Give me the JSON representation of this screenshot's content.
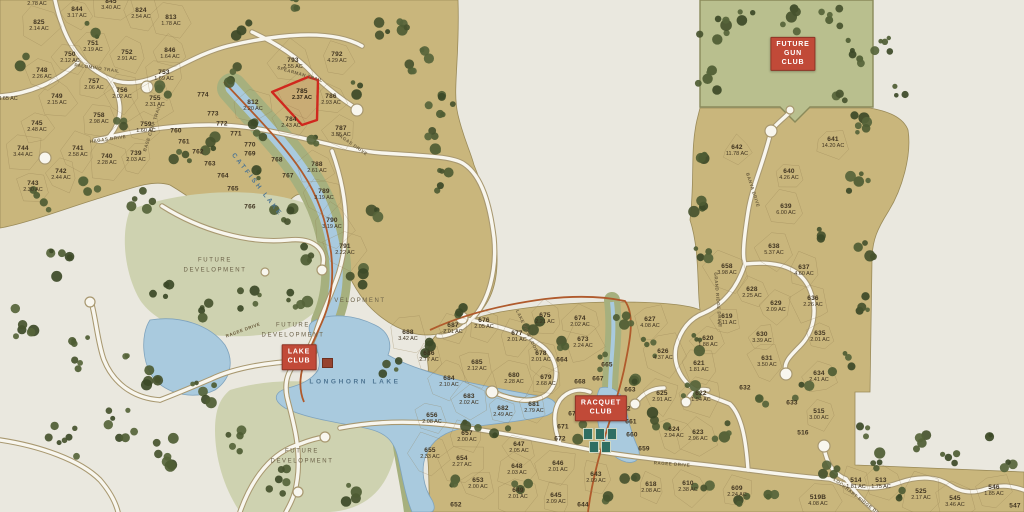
{
  "colors": {
    "parcel": "#c9b67c",
    "grass": "#a6b07e",
    "sage": "#ced2b0",
    "water": "#a9cade",
    "road": "#f8f6ee",
    "trail": "#b05a2c",
    "highlight": "#d0281e",
    "sign_red": "#c14a38",
    "text": "#3f3320"
  },
  "signs": [
    {
      "id": "future-gun-club",
      "text": "FUTURE\nGUN\nCLUB",
      "x": 793,
      "y": 54
    },
    {
      "id": "lake-club",
      "text": "LAKE\nCLUB",
      "x": 299,
      "y": 357
    },
    {
      "id": "racquet-club",
      "text": "RACQUET\nCLUB",
      "x": 601,
      "y": 408
    }
  ],
  "area_labels": [
    {
      "t": "FUTURE\nDEVELOPMENT",
      "x": 215,
      "y": 266
    },
    {
      "t": "FUTURE\nDEVELOPMENT",
      "x": 293,
      "y": 331
    },
    {
      "t": "FUTURE\nDEVELOPMENT",
      "x": 302,
      "y": 457
    },
    {
      "t": "VELOPMENT",
      "x": 360,
      "y": 302
    }
  ],
  "water_labels": [
    {
      "t": "CATFISH LAKE",
      "x": 257,
      "y": 185,
      "r": 52
    },
    {
      "t": "LONGHORN LAKE",
      "x": 355,
      "y": 382,
      "r": 0
    }
  ],
  "road_labels": [
    {
      "t": "PALOMINO TRAIL",
      "x": 97,
      "y": 68,
      "r": 8
    },
    {
      "t": "BASE CAMP TRAIL",
      "x": 152,
      "y": 128,
      "r": -72
    },
    {
      "t": "HAGAS DRIVE",
      "x": 108,
      "y": 139,
      "r": -8
    },
    {
      "t": "SPEARMAN TRAIL",
      "x": 300,
      "y": 74,
      "r": 16
    },
    {
      "t": "HAGAS DRIVE",
      "x": 352,
      "y": 144,
      "r": 35
    },
    {
      "t": "RAGEE DRIVE",
      "x": 243,
      "y": 330,
      "r": -20
    },
    {
      "t": "RAGEE DRIVE",
      "x": 672,
      "y": 464,
      "r": 4
    },
    {
      "t": "BANYA DRIVE",
      "x": 753,
      "y": 190,
      "r": 72
    },
    {
      "t": "GRAND RIDGE DRIVE",
      "x": 718,
      "y": 300,
      "r": 85
    },
    {
      "t": "LAKE VIEW LOOP",
      "x": 527,
      "y": 331,
      "r": 65
    },
    {
      "t": "LOCKHART RIDGE DRIVE",
      "x": 860,
      "y": 499,
      "r": 38
    }
  ],
  "lots": [
    {
      "n": "",
      "ac": "2.78 AC",
      "x": 37,
      "y": 4
    },
    {
      "n": "844",
      "ac": "3.17 AC",
      "x": 77,
      "y": 13
    },
    {
      "n": "845",
      "ac": "3.40 AC",
      "x": 111,
      "y": 5
    },
    {
      "n": "824",
      "ac": "2.54 AC",
      "x": 141,
      "y": 14
    },
    {
      "n": "813",
      "ac": "1.78 AC",
      "x": 171,
      "y": 21
    },
    {
      "n": "825",
      "ac": "2.14 AC",
      "x": 39,
      "y": 26
    },
    {
      "n": "751",
      "ac": "2.19 AC",
      "x": 93,
      "y": 47
    },
    {
      "n": "750",
      "ac": "2.12 AC",
      "x": 70,
      "y": 58
    },
    {
      "n": "752",
      "ac": "2.91 AC",
      "x": 127,
      "y": 56
    },
    {
      "n": "846",
      "ac": "1.64 AC",
      "x": 170,
      "y": 54
    },
    {
      "n": "748",
      "ac": "2.26 AC",
      "x": 42,
      "y": 74
    },
    {
      "n": "753",
      "ac": "1.69 AC",
      "x": 164,
      "y": 76
    },
    {
      "n": "757",
      "ac": "2.06 AC",
      "x": 94,
      "y": 85
    },
    {
      "n": "756",
      "ac": "2.02 AC",
      "x": 122,
      "y": 94
    },
    {
      "n": "749",
      "ac": "2.15 AC",
      "x": 57,
      "y": 100
    },
    {
      "n": "755",
      "ac": "2.31 AC",
      "x": 155,
      "y": 102
    },
    {
      "n": "",
      "ac": "3.65 AC",
      "x": 8,
      "y": 99
    },
    {
      "n": "758",
      "ac": "2.98 AC",
      "x": 99,
      "y": 119
    },
    {
      "n": "745",
      "ac": "2.48 AC",
      "x": 37,
      "y": 127
    },
    {
      "n": "759",
      "ac": "1.60 AC",
      "x": 146,
      "y": 128
    },
    {
      "n": "744",
      "ac": "3.44 AC",
      "x": 23,
      "y": 152
    },
    {
      "n": "741",
      "ac": "2.58 AC",
      "x": 78,
      "y": 152
    },
    {
      "n": "740",
      "ac": "2.28 AC",
      "x": 107,
      "y": 160
    },
    {
      "n": "739",
      "ac": "2.03 AC",
      "x": 136,
      "y": 157
    },
    {
      "n": "742",
      "ac": "2.44 AC",
      "x": 61,
      "y": 175
    },
    {
      "n": "743",
      "ac": "2.30 AC",
      "x": 33,
      "y": 187
    },
    {
      "n": "760",
      "ac": "",
      "x": 176,
      "y": 131
    },
    {
      "n": "761",
      "ac": "",
      "x": 184,
      "y": 142
    },
    {
      "n": "762",
      "ac": "",
      "x": 198,
      "y": 152
    },
    {
      "n": "763",
      "ac": "",
      "x": 210,
      "y": 164
    },
    {
      "n": "764",
      "ac": "",
      "x": 223,
      "y": 176
    },
    {
      "n": "765",
      "ac": "",
      "x": 233,
      "y": 189
    },
    {
      "n": "766",
      "ac": "",
      "x": 250,
      "y": 207
    },
    {
      "n": "767",
      "ac": "",
      "x": 288,
      "y": 176
    },
    {
      "n": "768",
      "ac": "",
      "x": 277,
      "y": 160
    },
    {
      "n": "769",
      "ac": "",
      "x": 250,
      "y": 154
    },
    {
      "n": "770",
      "ac": "",
      "x": 250,
      "y": 145
    },
    {
      "n": "771",
      "ac": "",
      "x": 236,
      "y": 134
    },
    {
      "n": "772",
      "ac": "",
      "x": 222,
      "y": 124
    },
    {
      "n": "773",
      "ac": "",
      "x": 213,
      "y": 114
    },
    {
      "n": "774",
      "ac": "",
      "x": 203,
      "y": 95
    },
    {
      "n": "793",
      "ac": "2.55 AC",
      "x": 293,
      "y": 64
    },
    {
      "n": "792",
      "ac": "4.29 AC",
      "x": 337,
      "y": 58
    },
    {
      "n": "785",
      "ac": "2.37 AC",
      "x": 302,
      "y": 95,
      "hl": true
    },
    {
      "n": "786",
      "ac": "2.93 AC",
      "x": 331,
      "y": 100
    },
    {
      "n": "812",
      "ac": "2.20 AC",
      "x": 253,
      "y": 106
    },
    {
      "n": "784",
      "ac": "2.43 AC",
      "x": 291,
      "y": 123
    },
    {
      "n": "787",
      "ac": "3.55 AC",
      "x": 341,
      "y": 132
    },
    {
      "n": "788",
      "ac": "2.61 AC",
      "x": 317,
      "y": 168
    },
    {
      "n": "789",
      "ac": "3.19 AC",
      "x": 324,
      "y": 195
    },
    {
      "n": "790",
      "ac": "3.19 AC",
      "x": 332,
      "y": 224
    },
    {
      "n": "791",
      "ac": "2.22 AC",
      "x": 345,
      "y": 250
    },
    {
      "n": "642",
      "ac": "11.78 AC",
      "x": 737,
      "y": 151
    },
    {
      "n": "641",
      "ac": "14.20 AC",
      "x": 833,
      "y": 143
    },
    {
      "n": "640",
      "ac": "4.26 AC",
      "x": 789,
      "y": 175
    },
    {
      "n": "639",
      "ac": "6.00 AC",
      "x": 786,
      "y": 210
    },
    {
      "n": "638",
      "ac": "5.37 AC",
      "x": 774,
      "y": 250
    },
    {
      "n": "637",
      "ac": "4.60 AC",
      "x": 804,
      "y": 271
    },
    {
      "n": "658",
      "ac": "3.98 AC",
      "x": 727,
      "y": 270
    },
    {
      "n": "628",
      "ac": "2.25 AC",
      "x": 752,
      "y": 293
    },
    {
      "n": "629",
      "ac": "2.09 AC",
      "x": 776,
      "y": 307
    },
    {
      "n": "636",
      "ac": "2.26 AC",
      "x": 813,
      "y": 302
    },
    {
      "n": "619",
      "ac": "2.11 AC",
      "x": 727,
      "y": 320
    },
    {
      "n": "620",
      "ac": "1.88 AC",
      "x": 708,
      "y": 342
    },
    {
      "n": "630",
      "ac": "3.39 AC",
      "x": 762,
      "y": 338
    },
    {
      "n": "635",
      "ac": "2.01 AC",
      "x": 820,
      "y": 337
    },
    {
      "n": "631",
      "ac": "3.50 AC",
      "x": 767,
      "y": 362
    },
    {
      "n": "621",
      "ac": "1.81 AC",
      "x": 699,
      "y": 367
    },
    {
      "n": "634",
      "ac": "2.41 AC",
      "x": 819,
      "y": 377
    },
    {
      "n": "632",
      "ac": "",
      "x": 745,
      "y": 388
    },
    {
      "n": "633",
      "ac": "",
      "x": 792,
      "y": 403
    },
    {
      "n": "688",
      "ac": "3.42 AC",
      "x": 408,
      "y": 336
    },
    {
      "n": "687",
      "ac": "2.01 AC",
      "x": 453,
      "y": 329
    },
    {
      "n": "676",
      "ac": "2.05 AC",
      "x": 484,
      "y": 324
    },
    {
      "n": "675",
      "ac": "2.21 AC",
      "x": 545,
      "y": 319
    },
    {
      "n": "677",
      "ac": "2.01 AC",
      "x": 517,
      "y": 337
    },
    {
      "n": "686",
      "ac": "2.77 AC",
      "x": 429,
      "y": 357
    },
    {
      "n": "685",
      "ac": "2.12 AC",
      "x": 477,
      "y": 366
    },
    {
      "n": "678",
      "ac": "2.01 AC",
      "x": 541,
      "y": 357
    },
    {
      "n": "680",
      "ac": "2.28 AC",
      "x": 514,
      "y": 379
    },
    {
      "n": "679",
      "ac": "2.68 AC",
      "x": 546,
      "y": 381
    },
    {
      "n": "684",
      "ac": "2.10 AC",
      "x": 449,
      "y": 382
    },
    {
      "n": "683",
      "ac": "2.02 AC",
      "x": 469,
      "y": 400
    },
    {
      "n": "682",
      "ac": "2.49 AC",
      "x": 503,
      "y": 412
    },
    {
      "n": "681",
      "ac": "2.79 AC",
      "x": 534,
      "y": 408
    },
    {
      "n": "674",
      "ac": "2.02 AC",
      "x": 580,
      "y": 322
    },
    {
      "n": "673",
      "ac": "2.24 AC",
      "x": 583,
      "y": 343
    },
    {
      "n": "627",
      "ac": "4.08 AC",
      "x": 650,
      "y": 323
    },
    {
      "n": "626",
      "ac": "4.37 AC",
      "x": 663,
      "y": 355
    },
    {
      "n": "664",
      "ac": "",
      "x": 562,
      "y": 360
    },
    {
      "n": "665",
      "ac": "",
      "x": 607,
      "y": 365
    },
    {
      "n": "667",
      "ac": "",
      "x": 598,
      "y": 379
    },
    {
      "n": "668",
      "ac": "",
      "x": 580,
      "y": 382
    },
    {
      "n": "663",
      "ac": "",
      "x": 630,
      "y": 390
    },
    {
      "n": "662",
      "ac": "",
      "x": 625,
      "y": 409
    },
    {
      "n": "661",
      "ac": "",
      "x": 631,
      "y": 422
    },
    {
      "n": "660",
      "ac": "",
      "x": 632,
      "y": 435
    },
    {
      "n": "659",
      "ac": "",
      "x": 644,
      "y": 449
    },
    {
      "n": "670",
      "ac": "",
      "x": 574,
      "y": 414
    },
    {
      "n": "671",
      "ac": "",
      "x": 563,
      "y": 427
    },
    {
      "n": "672",
      "ac": "",
      "x": 560,
      "y": 439
    },
    {
      "n": "625",
      "ac": "2.91 AC",
      "x": 662,
      "y": 397
    },
    {
      "n": "622",
      "ac": "1.94 AC",
      "x": 701,
      "y": 397
    },
    {
      "n": "624",
      "ac": "2.94 AC",
      "x": 674,
      "y": 433
    },
    {
      "n": "623",
      "ac": "2.96 AC",
      "x": 698,
      "y": 436
    },
    {
      "n": "656",
      "ac": "2.08 AC",
      "x": 432,
      "y": 419
    },
    {
      "n": "655",
      "ac": "2.33 AC",
      "x": 430,
      "y": 454
    },
    {
      "n": "657",
      "ac": "2.00 AC",
      "x": 467,
      "y": 437
    },
    {
      "n": "654",
      "ac": "2.27 AC",
      "x": 462,
      "y": 462
    },
    {
      "n": "653",
      "ac": "2.00 AC",
      "x": 478,
      "y": 484
    },
    {
      "n": "652",
      "ac": "",
      "x": 456,
      "y": 505
    },
    {
      "n": "647",
      "ac": "2.05 AC",
      "x": 519,
      "y": 448
    },
    {
      "n": "648",
      "ac": "2.03 AC",
      "x": 517,
      "y": 470
    },
    {
      "n": "649",
      "ac": "2.01 AC",
      "x": 518,
      "y": 494
    },
    {
      "n": "646",
      "ac": "2.01 AC",
      "x": 558,
      "y": 467
    },
    {
      "n": "645",
      "ac": "2.09 AC",
      "x": 556,
      "y": 499
    },
    {
      "n": "644",
      "ac": "",
      "x": 583,
      "y": 505
    },
    {
      "n": "643",
      "ac": "2.09 AC",
      "x": 596,
      "y": 478
    },
    {
      "n": "618",
      "ac": "2.08 AC",
      "x": 651,
      "y": 488
    },
    {
      "n": "610",
      "ac": "2.38 AC",
      "x": 688,
      "y": 487
    },
    {
      "n": "609",
      "ac": "2.24 AC",
      "x": 737,
      "y": 492
    },
    {
      "n": "515",
      "ac": "3.00 AC",
      "x": 819,
      "y": 415
    },
    {
      "n": "516",
      "ac": "",
      "x": 803,
      "y": 433
    },
    {
      "n": "514",
      "ac": "1.81 AC",
      "x": 856,
      "y": 484
    },
    {
      "n": "513",
      "ac": "1.75 AC",
      "x": 881,
      "y": 484
    },
    {
      "n": "525",
      "ac": "2.17 AC",
      "x": 921,
      "y": 495
    },
    {
      "n": "545",
      "ac": "3.46 AC",
      "x": 955,
      "y": 502
    },
    {
      "n": "546",
      "ac": "1.85 AC",
      "x": 994,
      "y": 491
    },
    {
      "n": "547",
      "ac": "",
      "x": 1015,
      "y": 506
    },
    {
      "n": "519B",
      "ac": "4.08 AC",
      "x": 818,
      "y": 501
    }
  ]
}
